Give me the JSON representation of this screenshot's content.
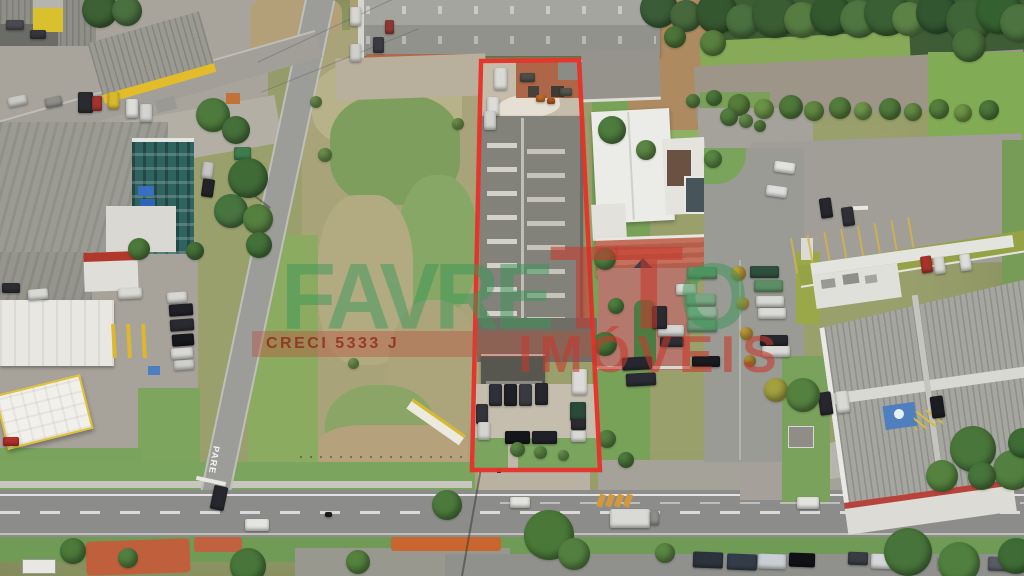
{
  "watermark": {
    "brand_green_1": "FAVRE",
    "brand_red_tt": "TT",
    "brand_green_2": "O",
    "subtitle": "IMÓVEIS",
    "license": "CRECI 5333 J",
    "colors": {
      "green": "rgba(58,150,88,0.50)",
      "red": "rgba(198,56,44,0.58)",
      "band": "rgba(186,80,60,0.40)",
      "band_text": "rgba(140,38,28,0.78)"
    }
  },
  "highlight_outline": {
    "color": "#e5332a",
    "stroke_width": 4.5,
    "points": "481,61 579,60 600,470 472,470"
  },
  "road_markings": {
    "stop_text": "PARE"
  },
  "vehicles": [
    [
      8,
      96,
      19,
      10,
      "#c9c9c5",
      -12
    ],
    [
      45,
      97,
      17,
      10,
      "#8e8e8a",
      -12
    ],
    [
      78,
      92,
      15,
      21,
      "#2a2b30",
      0
    ],
    [
      92,
      96,
      10,
      15,
      "#a33430",
      0
    ],
    [
      108,
      92,
      11,
      17,
      "#d9b92c",
      0
    ],
    [
      126,
      99,
      12,
      19,
      "#dcdcd8",
      0
    ],
    [
      140,
      104,
      12,
      18,
      "#d3d3cf",
      0
    ],
    [
      6,
      20,
      18,
      10,
      "#4a4b50",
      0
    ],
    [
      30,
      30,
      16,
      9,
      "#36373c",
      0
    ],
    [
      202,
      162,
      11,
      17,
      "#c4c4c0",
      8
    ],
    [
      202,
      179,
      12,
      18,
      "#222328",
      8
    ],
    [
      234,
      147,
      17,
      13,
      "#3e7c4e",
      0
    ],
    [
      350,
      7,
      11,
      19,
      "#d6d6d2",
      0
    ],
    [
      385,
      20,
      9,
      14,
      "#8e3a34",
      0
    ],
    [
      373,
      37,
      11,
      16,
      "#3b3c42",
      0
    ],
    [
      350,
      44,
      11,
      18,
      "#cfd0cc",
      0
    ],
    [
      2,
      283,
      18,
      10,
      "#2c2d33",
      0
    ],
    [
      28,
      289,
      20,
      11,
      "#d8d8d4",
      -5
    ],
    [
      118,
      288,
      24,
      11,
      "#d9d9d5",
      -3
    ],
    [
      3,
      437,
      16,
      9,
      "#b03028",
      0
    ],
    [
      167,
      292,
      20,
      11,
      "#d6d6d2",
      -4
    ],
    [
      169,
      304,
      24,
      12,
      "#1f2026",
      -4
    ],
    [
      170,
      319,
      24,
      12,
      "#2a2b31",
      -4
    ],
    [
      172,
      334,
      22,
      12,
      "#17181d",
      -4
    ],
    [
      171,
      348,
      22,
      11,
      "#d8d8d4",
      -4
    ],
    [
      174,
      360,
      20,
      10,
      "#cfcfcb",
      -4
    ],
    [
      212,
      486,
      14,
      24,
      "#26272d",
      12
    ],
    [
      245,
      519,
      24,
      12,
      "#e4e4e0",
      0
    ],
    [
      325,
      512,
      7,
      5,
      "#1c1c20",
      0
    ],
    [
      510,
      497,
      20,
      11,
      "#e2e2de",
      0
    ],
    [
      610,
      509,
      40,
      19,
      "#d9d9d5",
      0
    ],
    [
      650,
      511,
      9,
      14,
      "#8f8f89",
      0
    ],
    [
      797,
      497,
      22,
      12,
      "#e3e3df",
      0
    ],
    [
      693,
      552,
      30,
      16,
      "#2c333c",
      2
    ],
    [
      727,
      554,
      30,
      16,
      "#333c48",
      2
    ],
    [
      758,
      554,
      28,
      15,
      "#c9ced2",
      2
    ],
    [
      789,
      553,
      26,
      14,
      "#101116",
      2
    ],
    [
      848,
      552,
      20,
      13,
      "#393c44",
      2
    ],
    [
      871,
      554,
      28,
      15,
      "#d5d7d9",
      2
    ],
    [
      938,
      556,
      26,
      14,
      "#c2c4c6",
      2
    ],
    [
      988,
      557,
      26,
      14,
      "#575b63",
      2
    ],
    [
      494,
      68,
      13,
      22,
      "#d9d9d5",
      0
    ],
    [
      487,
      97,
      12,
      19,
      "#dcdcda",
      0
    ],
    [
      484,
      111,
      12,
      19,
      "#d2d2ce",
      0
    ],
    [
      520,
      73,
      15,
      9,
      "#4e4e48",
      0
    ],
    [
      536,
      95,
      9,
      7,
      "#c06a28",
      0
    ],
    [
      547,
      98,
      8,
      6,
      "#b5581f",
      0
    ],
    [
      560,
      88,
      12,
      8,
      "#55564f",
      0
    ],
    [
      489,
      384,
      13,
      22,
      "#2f3038",
      0
    ],
    [
      504,
      384,
      13,
      22,
      "#1f2026",
      0
    ],
    [
      519,
      384,
      13,
      22,
      "#3a3b42",
      0
    ],
    [
      535,
      383,
      13,
      22,
      "#26272d",
      0
    ],
    [
      572,
      369,
      15,
      26,
      "#dcdbd7",
      0
    ],
    [
      570,
      402,
      16,
      19,
      "#2b4a38",
      0
    ],
    [
      571,
      419,
      15,
      11,
      "#2b2c31",
      0
    ],
    [
      571,
      431,
      15,
      11,
      "#d8d8d4",
      0
    ],
    [
      505,
      431,
      25,
      13,
      "#15161b",
      0
    ],
    [
      532,
      431,
      25,
      13,
      "#202128",
      0
    ],
    [
      476,
      404,
      12,
      20,
      "#34353b",
      0
    ],
    [
      478,
      422,
      12,
      18,
      "#d4d4d0",
      0
    ],
    [
      676,
      284,
      20,
      11,
      "#d8d8d4",
      0
    ],
    [
      687,
      267,
      30,
      12,
      "#5f9468",
      0
    ],
    [
      686,
      294,
      30,
      12,
      "#79a583",
      0
    ],
    [
      687,
      307,
      30,
      12,
      "#8fb498",
      0
    ],
    [
      687,
      320,
      30,
      12,
      "#6d9a77",
      0
    ],
    [
      658,
      325,
      26,
      11,
      "#d5d5d1",
      0
    ],
    [
      660,
      337,
      24,
      10,
      "#2e2f35",
      0
    ],
    [
      692,
      356,
      28,
      11,
      "#191a1f",
      0
    ],
    [
      652,
      306,
      15,
      23,
      "#2a2b31",
      0
    ],
    [
      750,
      266,
      29,
      12,
      "#2f4f3c",
      0
    ],
    [
      754,
      280,
      29,
      12,
      "#5d8f66",
      0
    ],
    [
      756,
      296,
      28,
      11,
      "#d7d7d3",
      0
    ],
    [
      758,
      308,
      28,
      11,
      "#dadad6",
      0
    ],
    [
      760,
      335,
      28,
      11,
      "#26272d",
      0
    ],
    [
      762,
      346,
      28,
      11,
      "#d8d8d4",
      0
    ],
    [
      622,
      357,
      30,
      13,
      "#26272e",
      -3
    ],
    [
      626,
      373,
      30,
      13,
      "#2a2b33",
      -3
    ],
    [
      774,
      162,
      21,
      11,
      "#e2e2de",
      8
    ],
    [
      766,
      186,
      21,
      11,
      "#dedede",
      8
    ],
    [
      820,
      198,
      12,
      20,
      "#26272d",
      -8
    ],
    [
      842,
      207,
      12,
      19,
      "#2f3036",
      -8
    ],
    [
      921,
      256,
      11,
      17,
      "#a8322c",
      -8
    ],
    [
      934,
      257,
      11,
      17,
      "#d9d9d5",
      -8
    ],
    [
      960,
      254,
      11,
      17,
      "#dddddb",
      -8
    ],
    [
      819,
      392,
      13,
      23,
      "#26272c",
      -8
    ],
    [
      836,
      391,
      13,
      22,
      "#d9d9d5",
      -8
    ],
    [
      931,
      396,
      13,
      22,
      "#1c1d22",
      -8
    ]
  ],
  "trees": [
    [
      640,
      -10,
      38,
      "#3a5c36"
    ],
    [
      670,
      0,
      32,
      "#47683c"
    ],
    [
      696,
      -8,
      42,
      "#35572f"
    ],
    [
      726,
      4,
      34,
      "#4a7040"
    ],
    [
      752,
      -8,
      46,
      "#3b5d33"
    ],
    [
      784,
      2,
      36,
      "#567c42"
    ],
    [
      810,
      -6,
      42,
      "#33582e"
    ],
    [
      840,
      0,
      38,
      "#4f7540"
    ],
    [
      864,
      -10,
      46,
      "#3a5f34"
    ],
    [
      892,
      2,
      34,
      "#5d8246"
    ],
    [
      916,
      -8,
      42,
      "#315630"
    ],
    [
      946,
      -2,
      46,
      "#3f6437"
    ],
    [
      976,
      -12,
      46,
      "#356030"
    ],
    [
      1000,
      4,
      38,
      "#4c7340"
    ],
    [
      952,
      28,
      34,
      "#49703b"
    ],
    [
      700,
      30,
      26,
      "#58803f"
    ],
    [
      664,
      26,
      22,
      "#4c7438"
    ],
    [
      728,
      94,
      22,
      "#577d3b"
    ],
    [
      754,
      99,
      20,
      "#6b9346"
    ],
    [
      779,
      95,
      24,
      "#4f783a"
    ],
    [
      804,
      101,
      20,
      "#628840"
    ],
    [
      829,
      97,
      22,
      "#547c3b"
    ],
    [
      854,
      102,
      18,
      "#6e9449"
    ],
    [
      879,
      98,
      22,
      "#507a3a"
    ],
    [
      904,
      103,
      18,
      "#648a42"
    ],
    [
      929,
      99,
      20,
      "#567e3c"
    ],
    [
      954,
      104,
      18,
      "#6f9547"
    ],
    [
      979,
      100,
      20,
      "#4d763a"
    ],
    [
      82,
      -8,
      36,
      "#3d6034"
    ],
    [
      112,
      -4,
      30,
      "#4a7040"
    ],
    [
      196,
      98,
      34,
      "#4e7b3d"
    ],
    [
      222,
      116,
      28,
      "#45703a"
    ],
    [
      228,
      158,
      40,
      "#3f6b37"
    ],
    [
      214,
      194,
      34,
      "#487440"
    ],
    [
      243,
      204,
      30,
      "#55813f"
    ],
    [
      246,
      232,
      26,
      "#44703a"
    ],
    [
      318,
      148,
      14,
      "#6c9150"
    ],
    [
      452,
      118,
      12,
      "#71954f"
    ],
    [
      348,
      358,
      11,
      "#7a9c55"
    ],
    [
      310,
      96,
      12,
      "#6f9350"
    ],
    [
      598,
      116,
      28,
      "#4e7b3e"
    ],
    [
      594,
      248,
      22,
      "#527e40"
    ],
    [
      593,
      332,
      24,
      "#487539"
    ],
    [
      598,
      430,
      18,
      "#55823f"
    ],
    [
      618,
      452,
      16,
      "#4d7a3b"
    ],
    [
      636,
      140,
      20,
      "#5b8845"
    ],
    [
      608,
      298,
      16,
      "#4e8040"
    ],
    [
      704,
      150,
      18,
      "#5a8745"
    ],
    [
      720,
      108,
      18,
      "#527f3f"
    ],
    [
      739,
      114,
      14,
      "#64904a"
    ],
    [
      754,
      120,
      12,
      "#578340"
    ],
    [
      731,
      266,
      15,
      "#c29f3a"
    ],
    [
      736,
      297,
      13,
      "#cfa93f"
    ],
    [
      740,
      327,
      13,
      "#c49f38"
    ],
    [
      744,
      355,
      12,
      "#b99637"
    ],
    [
      764,
      378,
      24,
      "#a3a13f"
    ],
    [
      786,
      378,
      34,
      "#55813f"
    ],
    [
      950,
      426,
      46,
      "#49763a"
    ],
    [
      993,
      450,
      40,
      "#528040"
    ],
    [
      926,
      460,
      32,
      "#55833f"
    ],
    [
      1008,
      428,
      30,
      "#3f6c35"
    ],
    [
      968,
      462,
      28,
      "#47743a"
    ],
    [
      60,
      538,
      26,
      "#4c7a3b"
    ],
    [
      230,
      548,
      36,
      "#487539"
    ],
    [
      346,
      550,
      24,
      "#55823e"
    ],
    [
      524,
      510,
      50,
      "#4a7839"
    ],
    [
      558,
      538,
      32,
      "#538040"
    ],
    [
      655,
      543,
      20,
      "#5a8742"
    ],
    [
      884,
      528,
      48,
      "#47743a"
    ],
    [
      938,
      542,
      42,
      "#508040"
    ],
    [
      998,
      538,
      36,
      "#3f6c36"
    ],
    [
      432,
      490,
      30,
      "#4c7a3c"
    ],
    [
      118,
      548,
      20,
      "#538040"
    ],
    [
      128,
      238,
      22,
      "#4d7a3c"
    ],
    [
      186,
      242,
      18,
      "#45713a"
    ],
    [
      510,
      442,
      15,
      "#5a8a46"
    ],
    [
      534,
      446,
      13,
      "#639148"
    ],
    [
      558,
      450,
      11,
      "#6b9850"
    ],
    [
      706,
      90,
      16,
      "#4c7a3b"
    ],
    [
      686,
      94,
      14,
      "#588340"
    ]
  ]
}
